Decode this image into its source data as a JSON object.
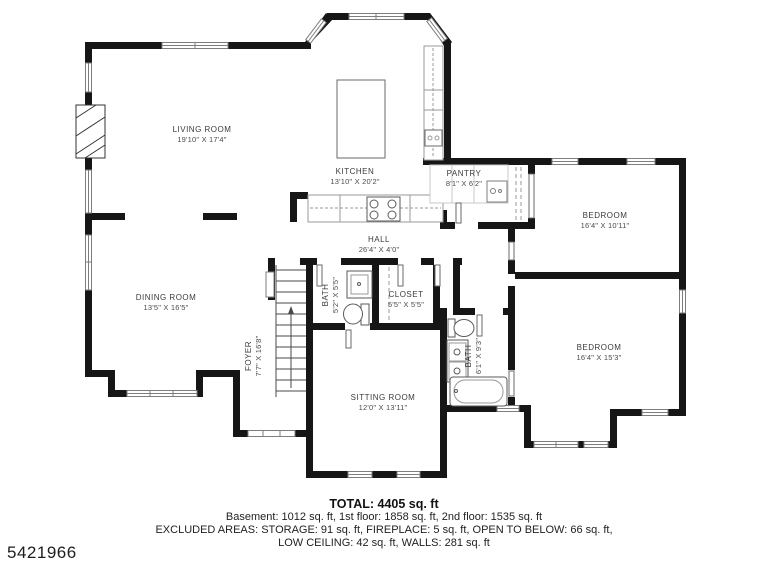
{
  "plan": {
    "rooms": [
      {
        "name": "LIVING ROOM",
        "dims": "19'10\" X 17'4\""
      },
      {
        "name": "KITCHEN",
        "dims": "13'10\" X 20'2\""
      },
      {
        "name": "PANTRY",
        "dims": "8'1\" X 6'2\""
      },
      {
        "name": "BEDROOM",
        "dims": "16'4\" X 10'11\""
      },
      {
        "name": "HALL",
        "dims": "26'4\" X 4'0\""
      },
      {
        "name": "DINING ROOM",
        "dims": "13'5\" X 16'5\""
      },
      {
        "name": "BATH",
        "dims": "5'2\" X 5'5\""
      },
      {
        "name": "CLOSET",
        "dims": "5'5\" X 5'5\""
      },
      {
        "name": "FOYER",
        "dims": "7'7\" X 16'8\""
      },
      {
        "name": "BATH",
        "dims": "6'1\" X 9'3\""
      },
      {
        "name": "BEDROOM",
        "dims": "16'4\" X 15'3\""
      },
      {
        "name": "SITTING ROOM",
        "dims": "12'0\" X 13'11\""
      }
    ]
  },
  "summary": {
    "total": "TOTAL: 4405 sq. ft",
    "floors": "Basement: 1012 sq. ft, 1st floor: 1858 sq. ft, 2nd floor: 1535 sq. ft",
    "excluded_line1": "EXCLUDED AREAS: STORAGE: 91 sq. ft, FIREPLACE: 5 sq. ft, OPEN TO BELOW: 66 sq. ft,",
    "excluded_line2": "LOW CEILING: 42 sq. ft, WALLS: 281 sq. ft"
  },
  "watermark": {
    "id": "5421966"
  },
  "colors": {
    "wall": "#161616",
    "window_stroke": "#7d7d7d",
    "fixture_stroke": "#5a5a5a",
    "counter_stroke": "#9a9a9a",
    "text": "#222222"
  }
}
